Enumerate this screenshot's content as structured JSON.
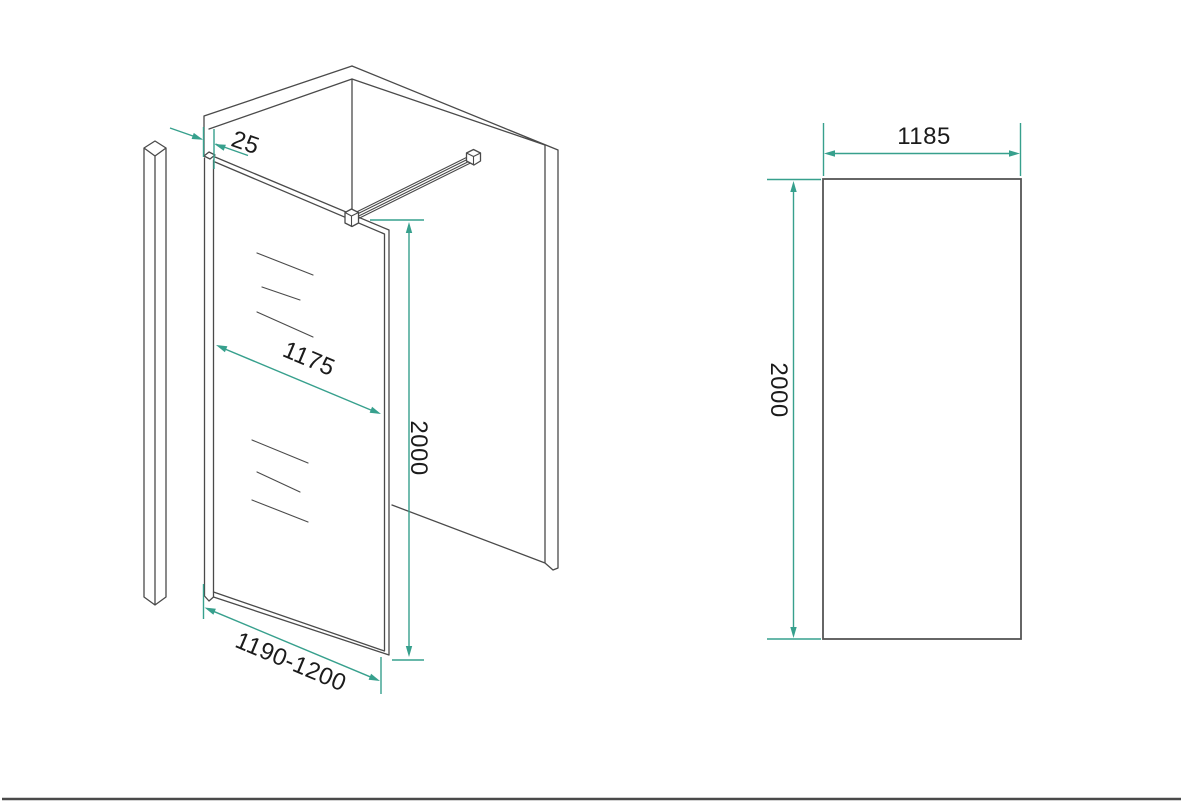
{
  "colors": {
    "background": "#ffffff",
    "drawing_line": "#4a4a4a",
    "dimension_accent": "#37a08d",
    "label_text": "#1b1b1b",
    "footer_rule": "#4a4a4a"
  },
  "perspective_view": {
    "profile_width_label": "25",
    "glass_width_label": "1175",
    "height_label": "2000",
    "total_width_label": "1190-1200"
  },
  "front_view": {
    "width_label": "1185",
    "height_label": "2000"
  }
}
